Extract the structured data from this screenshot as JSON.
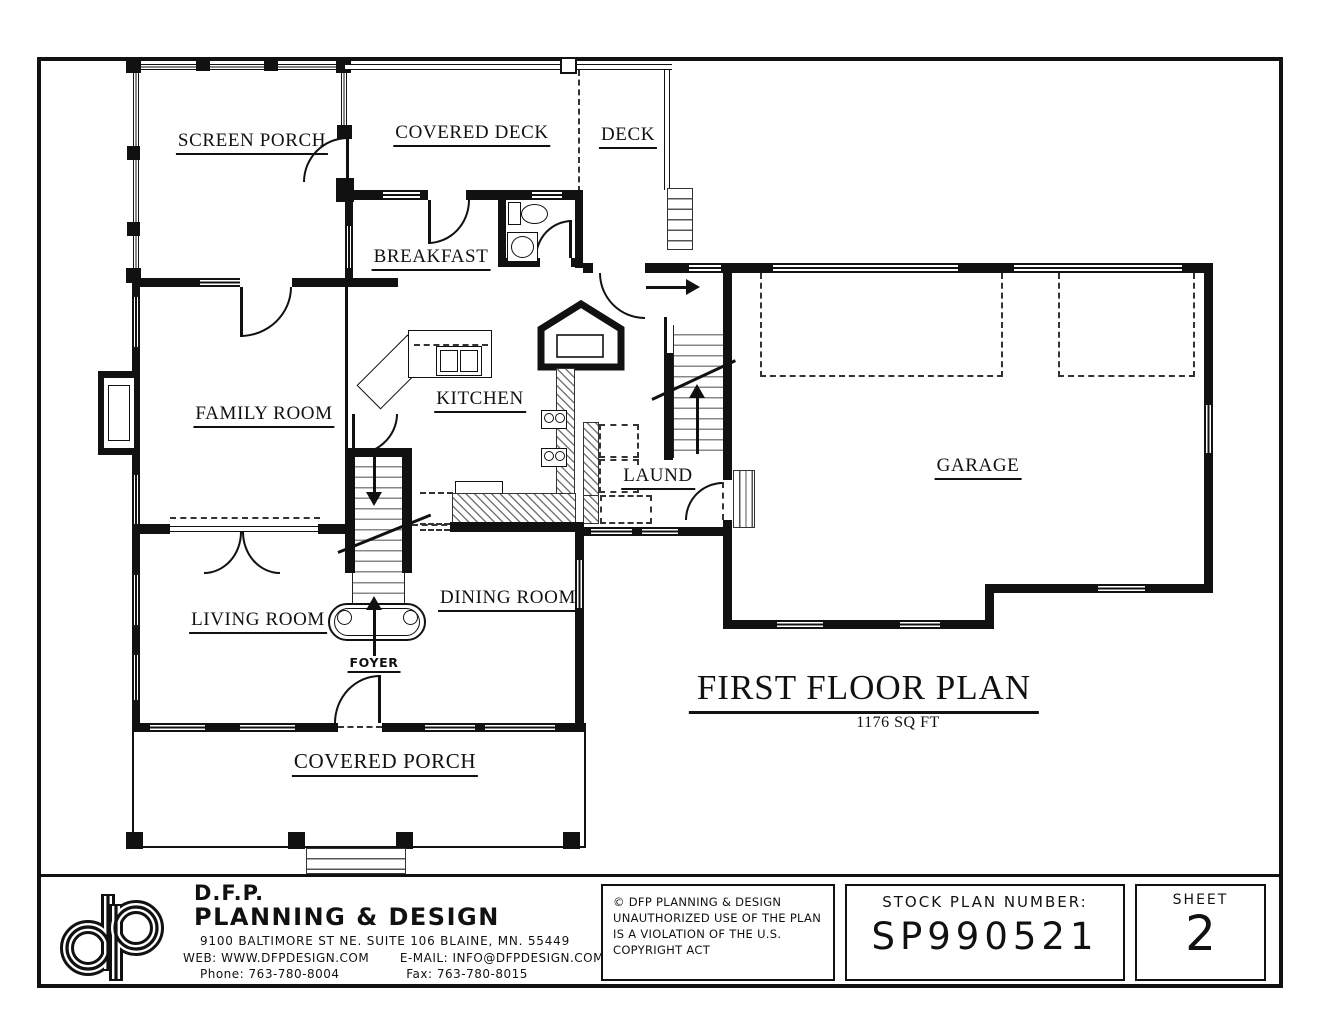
{
  "rooms": {
    "screen_porch": "SCREEN PORCH",
    "covered_deck": "COVERED DECK",
    "deck": "DECK",
    "breakfast": "BREAKFAST",
    "family_room": "FAMILY ROOM",
    "kitchen": "KITCHEN",
    "laundry": "LAUND",
    "garage": "GARAGE",
    "living_room": "LIVING ROOM",
    "dining_room": "DINING ROOM",
    "foyer": "FOYER",
    "covered_porch": "COVERED PORCH"
  },
  "plan_title": {
    "main": "FIRST FLOOR PLAN",
    "area": "1176 SQ FT"
  },
  "title_block": {
    "logo_text": "dp",
    "company_short": "D.F.P.",
    "company_name": "PLANNING & DESIGN",
    "address": "9100 BALTIMORE ST NE. SUITE 106 BLAINE, MN. 55449",
    "web_label": "WEB:",
    "web_value": "WWW.DFPDESIGN.COM",
    "email_label": "E-MAIL:",
    "email_value": "INFO@DFPDESIGN.COM",
    "phone_label": "Phone:",
    "phone_value": "763-780-8004",
    "fax_label": "Fax:",
    "fax_value": "763-780-8015",
    "copyright_lines": [
      "© DFP PLANNING & DESIGN",
      "UNAUTHORIZED USE OF THE PLAN",
      "IS A VIOLATION OF THE U.S.",
      "COPYRIGHT ACT"
    ],
    "stock_plan_label": "STOCK PLAN NUMBER:",
    "stock_plan_number": "SP990521",
    "sheet_label": "SHEET",
    "sheet_number": "2"
  },
  "colors": {
    "ink": "#111111",
    "paper": "#ffffff"
  }
}
